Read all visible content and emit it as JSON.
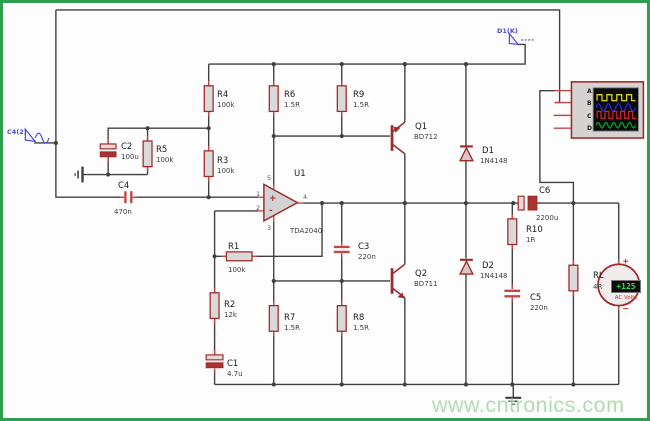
{
  "components": {
    "r1": {
      "ref": "R1",
      "value": "100k"
    },
    "r2": {
      "ref": "R2",
      "value": "12k"
    },
    "r3": {
      "ref": "R3",
      "value": "100k"
    },
    "r4": {
      "ref": "R4",
      "value": "100k"
    },
    "r5": {
      "ref": "R5",
      "value": "100k"
    },
    "r6": {
      "ref": "R6",
      "value": "1.5R"
    },
    "r7": {
      "ref": "R7",
      "value": "1.5R"
    },
    "r8": {
      "ref": "R8",
      "value": "1.5R"
    },
    "r9": {
      "ref": "R9",
      "value": "1.5R"
    },
    "r10": {
      "ref": "R10",
      "value": "1R"
    },
    "rl": {
      "ref": "RL",
      "value": "4R"
    },
    "c1": {
      "ref": "C1",
      "value": "4.7u"
    },
    "c2": {
      "ref": "C2",
      "value": "100u"
    },
    "c3": {
      "ref": "C3",
      "value": "220n"
    },
    "c4": {
      "ref": "C4",
      "value": "470n"
    },
    "c5": {
      "ref": "C5",
      "value": "220n"
    },
    "c6": {
      "ref": "C6",
      "value": "2200u"
    },
    "d1": {
      "ref": "D1",
      "value": "1N4148"
    },
    "d2": {
      "ref": "D2",
      "value": "1N4148"
    },
    "q1": {
      "ref": "Q1",
      "value": "BD712"
    },
    "q2": {
      "ref": "Q2",
      "value": "BD711"
    },
    "u1": {
      "ref": "U1",
      "value": "TDA2040"
    }
  },
  "opamp": {
    "pin_noninv": "1",
    "pin_inv": "2",
    "pin_vplus": "5",
    "pin_vminus": "3",
    "pin_out": "4",
    "plus_sign": "+",
    "minus_sign": "-"
  },
  "probes": {
    "input_generator": "C4(2)",
    "output_probe": "D1(K)"
  },
  "oscilloscope": {
    "channel_a": "A",
    "channel_b": "B",
    "channel_c": "C",
    "channel_d": "D"
  },
  "voltmeter": {
    "reading": "+125",
    "label": "AC Volts"
  },
  "watermark": {
    "text": "www.cntronics.com"
  },
  "colors": {
    "wire": "#3f3f3f",
    "component_red": "#9e2b2b",
    "pin_red": "#c24848",
    "probe_blue": "#4a4ad0",
    "frame_green": "#2f9e4e",
    "watermark_green": "#9fd2a1",
    "scope_yellow": "#d8d800",
    "scope_blue": "#2525dd",
    "scope_red": "#cc2222",
    "scope_green": "#00aa22",
    "lcd_green": "#2ee04e"
  }
}
